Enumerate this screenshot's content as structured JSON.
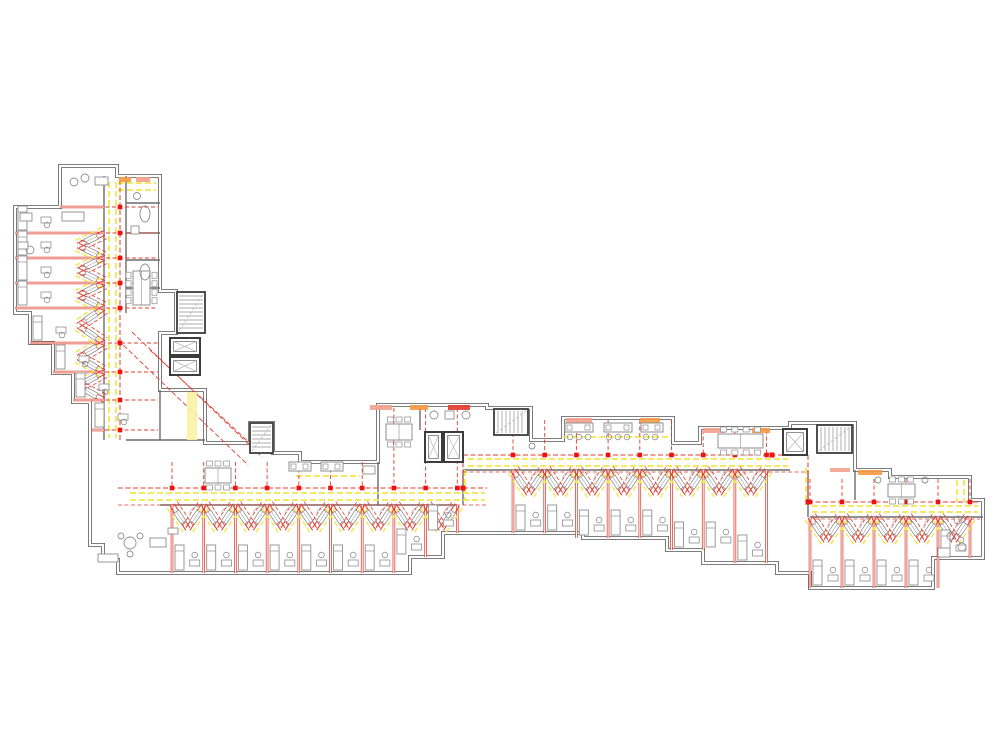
{
  "meta": {
    "app": "architectural-floor-plan",
    "description": "Renovation floor plan of an L-shaped residential building: grey existing walls, yellow demolition markings, red new-construction markings",
    "canvas_w": 1000,
    "canvas_h": 750
  },
  "colors": {
    "wall": "#6b6b6b",
    "wallDark": "#3c3c3c",
    "red": "#e23b2e",
    "redBright": "#ee1111",
    "salmon": "#f4a08c",
    "orange": "#f59a40",
    "yellow": "#f2e84b",
    "yellowPale": "#faf3a8",
    "furn": "#8f8f8f",
    "furnLight": "#b8b8b8",
    "white": "#ffffff"
  },
  "outline_path": "M60,166 L117,166 L117,176 L160,176 L160,291 L176,291 L176,333 L160,333 L160,390 L205,390 L205,443 L250,443 L250,423 L273,423 L273,453 L300,453 L300,462 L378,462 L378,405 L487,405 L487,408 L531,408 L531,440 L563,440 L563,418 L673,418 L673,443 L700,443 L700,428 L790,428 L790,423 L855,423 L855,470 L890,470 L890,477 L970,477 L970,500 L983,500 L983,558 L933,558 L933,588 L810,588 L810,573 L777,573 L777,563 L703,563 L703,550 L667,550 L667,538 L583,538 L583,533 L443,533 L443,557 L410,557 L410,573 L118,573 L118,560 L103,560 L103,545 L90,545 L90,402 L73,402 L73,373 L53,373 L53,343 L30,343 L30,313 L15,313 L15,207 L60,207 Z",
  "inner_walls": [
    [
      104,
      176,
      104,
      440
    ],
    [
      126,
      176,
      126,
      313
    ],
    [
      126,
      203,
      160,
      203
    ],
    [
      126,
      233,
      160,
      233
    ],
    [
      126,
      260,
      160,
      260
    ],
    [
      126,
      288,
      160,
      288
    ],
    [
      160,
      390,
      160,
      440
    ],
    [
      126,
      440,
      205,
      440
    ],
    [
      160,
      505,
      457,
      505
    ],
    [
      463,
      470,
      790,
      470
    ],
    [
      810,
      517,
      983,
      517
    ],
    [
      463,
      470,
      463,
      505
    ],
    [
      808,
      470,
      808,
      517
    ],
    [
      378,
      462,
      378,
      505
    ],
    [
      420,
      408,
      420,
      430
    ],
    [
      855,
      470,
      855,
      500
    ]
  ],
  "yellow_lines": [
    [
      109,
      182,
      109,
      438
    ],
    [
      116,
      182,
      116,
      438
    ],
    [
      118,
      183,
      156,
      183
    ],
    [
      118,
      190,
      156,
      190
    ],
    [
      130,
      493,
      485,
      493
    ],
    [
      130,
      500,
      485,
      500
    ],
    [
      468,
      459,
      788,
      459
    ],
    [
      468,
      466,
      788,
      466
    ],
    [
      812,
      506,
      978,
      506
    ],
    [
      812,
      512,
      978,
      512
    ],
    [
      465,
      470,
      465,
      500
    ],
    [
      806,
      468,
      806,
      505
    ],
    [
      957,
      480,
      957,
      502
    ],
    [
      964,
      480,
      964,
      502
    ],
    [
      189,
      393,
      189,
      440
    ],
    [
      196,
      393,
      196,
      440
    ],
    [
      563,
      437,
      668,
      437
    ],
    [
      296,
      476,
      360,
      476
    ]
  ],
  "corridors": {
    "west": {
      "y": 488,
      "x1": 118,
      "x2": 487
    },
    "middle": {
      "y": 455,
      "x1": 463,
      "x2": 808
    },
    "east": {
      "y": 502,
      "x1": 808,
      "x2": 980
    },
    "jogs": [
      [
        463,
        455,
        463,
        488
      ],
      [
        808,
        455,
        808,
        502
      ]
    ]
  },
  "sections": [
    {
      "name": "west",
      "x0": 172,
      "dx": 31.7,
      "n": 9,
      "wallY": 505,
      "corrY": 488,
      "bottoms": [
        573,
        573,
        573,
        573,
        573,
        573,
        573,
        557,
        533
      ],
      "topBreaks": [
        {
          "until": 378,
          "y": 462
        },
        {
          "until": 999,
          "y": 408
        }
      ]
    },
    {
      "name": "middle",
      "x0": 513,
      "dx": 31.7,
      "n": 8,
      "wallY": 470,
      "corrY": 455,
      "bottoms": [
        533,
        533,
        538,
        538,
        538,
        550,
        550,
        563
      ],
      "topBreaks": [
        {
          "until": 673,
          "y": 420
        },
        {
          "until": 700,
          "y": 445
        },
        {
          "until": 999,
          "y": 430
        }
      ]
    },
    {
      "name": "east",
      "x0": 810,
      "dx": 32,
      "n": 5,
      "wallY": 517,
      "corrY": 502,
      "bottoms": [
        588,
        588,
        588,
        588,
        558
      ],
      "topBreaks": [
        {
          "until": 999,
          "y": 479
        }
      ]
    }
  ],
  "nw_section": {
    "corrX": 120,
    "wallX": 104,
    "dashEndX": 158,
    "rows": [
      {
        "y": 207,
        "xl": 60,
        "chev": false
      },
      {
        "y": 233,
        "xl": 15,
        "chev": true
      },
      {
        "y": 258,
        "xl": 15,
        "chev": true
      },
      {
        "y": 283,
        "xl": 15,
        "chev": true
      },
      {
        "y": 308,
        "xl": 15,
        "chev": true
      },
      {
        "y": 343,
        "xl": 30,
        "chev": true
      },
      {
        "y": 372,
        "xl": 53,
        "chev": true
      },
      {
        "y": 400,
        "xl": 73,
        "chev": true
      },
      {
        "y": 430,
        "xl": 92,
        "chev": false
      }
    ]
  },
  "corner_diagonals": [
    [
      118,
      340,
      248,
      465
    ],
    [
      132,
      332,
      262,
      457
    ],
    [
      150,
      350,
      255,
      448
    ]
  ],
  "stairs": [
    {
      "x": 177,
      "y": 292,
      "w": 28,
      "h": 41,
      "dir": "v"
    },
    {
      "x": 250,
      "y": 423,
      "w": 23,
      "h": 30,
      "dir": "v"
    },
    {
      "x": 494,
      "y": 409,
      "w": 34,
      "h": 26,
      "dir": "h"
    },
    {
      "x": 817,
      "y": 425,
      "w": 35,
      "h": 28,
      "dir": "h"
    }
  ],
  "elevators": [
    {
      "x": 170,
      "y": 338,
      "w": 30,
      "h": 17
    },
    {
      "x": 170,
      "y": 357,
      "w": 30,
      "h": 18
    },
    {
      "x": 425,
      "y": 432,
      "w": 17,
      "h": 30
    },
    {
      "x": 444,
      "y": 432,
      "w": 19,
      "h": 30
    },
    {
      "x": 783,
      "y": 429,
      "w": 24,
      "h": 26
    }
  ],
  "tables": [
    {
      "x": 133,
      "y": 271,
      "w": 17,
      "h": 34,
      "o": "v",
      "chairs": 8
    },
    {
      "x": 205,
      "y": 468,
      "w": 26,
      "h": 15,
      "o": "h",
      "chairs": 6
    },
    {
      "x": 386,
      "y": 424,
      "w": 26,
      "h": 16,
      "o": "h",
      "chairs": 6
    },
    {
      "x": 718,
      "y": 434,
      "w": 45,
      "h": 14,
      "o": "h",
      "chairs": 8
    },
    {
      "x": 888,
      "y": 484,
      "w": 27,
      "h": 13,
      "o": "h",
      "chairs": 6
    }
  ],
  "counters": [
    {
      "x": 289,
      "y": 462,
      "w": 22,
      "h": 9,
      "stools": 0
    },
    {
      "x": 321,
      "y": 462,
      "w": 22,
      "h": 9,
      "stools": 0
    },
    {
      "x": 565,
      "y": 423,
      "w": 28,
      "h": 9,
      "stools": 3
    },
    {
      "x": 604,
      "y": 423,
      "w": 28,
      "h": 9,
      "stools": 3
    },
    {
      "x": 641,
      "y": 423,
      "w": 22,
      "h": 9,
      "stools": 2
    }
  ],
  "accents": [
    {
      "x": 119,
      "y": 177,
      "w": 12,
      "h": 5,
      "c": "orange"
    },
    {
      "x": 136,
      "y": 177,
      "w": 14,
      "h": 5,
      "c": "salmon"
    },
    {
      "x": 370,
      "y": 405,
      "w": 22,
      "h": 5,
      "c": "salmon"
    },
    {
      "x": 410,
      "y": 405,
      "w": 18,
      "h": 5,
      "c": "orange"
    },
    {
      "x": 448,
      "y": 405,
      "w": 22,
      "h": 5,
      "c": "red"
    },
    {
      "x": 566,
      "y": 418,
      "w": 26,
      "h": 5,
      "c": "salmon"
    },
    {
      "x": 640,
      "y": 418,
      "w": 20,
      "h": 5,
      "c": "orange"
    },
    {
      "x": 703,
      "y": 428,
      "w": 22,
      "h": 5,
      "c": "salmon"
    },
    {
      "x": 752,
      "y": 428,
      "w": 18,
      "h": 5,
      "c": "orange"
    },
    {
      "x": 858,
      "y": 470,
      "w": 24,
      "h": 5,
      "c": "orange"
    },
    {
      "x": 830,
      "y": 468,
      "w": 20,
      "h": 4,
      "c": "salmon"
    },
    {
      "x": 187,
      "y": 392,
      "w": 10,
      "h": 48,
      "c": "yellowPale"
    }
  ],
  "misc": [
    {
      "t": "ellipse",
      "x": 145,
      "y": 214,
      "rx": 5,
      "ry": 8
    },
    {
      "t": "ellipse",
      "x": 145,
      "y": 272,
      "rx": 5,
      "ry": 8
    },
    {
      "t": "rect",
      "x": 131,
      "y": 226,
      "w": 8,
      "h": 8
    },
    {
      "t": "circle",
      "x": 137,
      "y": 196,
      "r": 3.5
    },
    {
      "t": "circle",
      "x": 130,
      "y": 543,
      "r": 6
    },
    {
      "t": "circle",
      "x": 121,
      "y": 536,
      "r": 3
    },
    {
      "t": "circle",
      "x": 140,
      "y": 536,
      "r": 3
    },
    {
      "t": "circle",
      "x": 130,
      "y": 554,
      "r": 3
    },
    {
      "t": "rect",
      "x": 98,
      "y": 554,
      "w": 20,
      "h": 8
    },
    {
      "t": "rect",
      "x": 150,
      "y": 538,
      "w": 16,
      "h": 9
    },
    {
      "t": "rect",
      "x": 62,
      "y": 212,
      "w": 22,
      "h": 9
    },
    {
      "t": "circle",
      "x": 74,
      "y": 182,
      "r": 4
    },
    {
      "t": "circle",
      "x": 85,
      "y": 178,
      "r": 4
    },
    {
      "t": "rect",
      "x": 95,
      "y": 177,
      "w": 13,
      "h": 8
    },
    {
      "t": "rect",
      "x": 20,
      "y": 213,
      "w": 12,
      "h": 8
    },
    {
      "t": "circle",
      "x": 30,
      "y": 250,
      "r": 4
    },
    {
      "t": "rect",
      "x": 18,
      "y": 242,
      "w": 10,
      "h": 7
    },
    {
      "t": "circle",
      "x": 434,
      "y": 415,
      "r": 4
    },
    {
      "t": "rect",
      "x": 445,
      "y": 411,
      "w": 9,
      "h": 8
    },
    {
      "t": "circle",
      "x": 466,
      "y": 415,
      "r": 4
    },
    {
      "t": "circle",
      "x": 878,
      "y": 480,
      "r": 3
    },
    {
      "t": "circle",
      "x": 925,
      "y": 480,
      "r": 3
    },
    {
      "t": "circle",
      "x": 958,
      "y": 520,
      "r": 4
    },
    {
      "t": "circle",
      "x": 951,
      "y": 536,
      "r": 4
    },
    {
      "t": "circle",
      "x": 962,
      "y": 547,
      "r": 4
    },
    {
      "t": "rect",
      "x": 938,
      "y": 548,
      "w": 12,
      "h": 9
    },
    {
      "t": "rect",
      "x": 363,
      "y": 466,
      "w": 12,
      "h": 8
    },
    {
      "t": "circle",
      "x": 532,
      "y": 446,
      "r": 3
    },
    {
      "t": "rect",
      "x": 168,
      "y": 528,
      "w": 10,
      "h": 6
    }
  ]
}
